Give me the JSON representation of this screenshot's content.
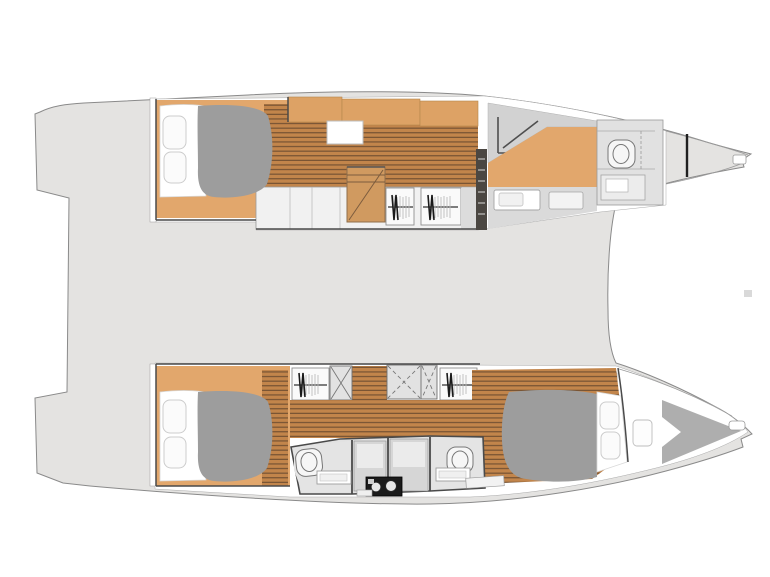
{
  "page": {
    "background": "#ffffff",
    "title": "Catamaran interior floor plan",
    "view": "top-down accommodation layout",
    "vessel_type": "sailing catamaran"
  },
  "colors": {
    "deck": "#e4e3e1",
    "outline": "#8a8a8a",
    "hull_interior": "#ffffff",
    "wall_dark": "#4a4a4a",
    "cabin_floor": "#e2a76c",
    "plank_floor": "#c2854b",
    "plank_line": "#6f4e31",
    "furniture": "#dda265",
    "stairs": "#d09a60",
    "bed_duvet": "#9d9d9d",
    "pillow": "#fbfbfb",
    "pillow_stroke": "#cccccc",
    "wet_floor": "#e2e2e2",
    "wet_panel": "#d6d6d6",
    "fixture": "#f6f6f6",
    "fixture_stroke": "#777777",
    "bow_berth": "#aeaeae",
    "louver": "#4b4742",
    "appliance": "#1b1b1b",
    "artifact": "#d9d9d9"
  },
  "plan": {
    "hulls": [
      {
        "name": "upper hull",
        "bow": "right",
        "rooms": [
          {
            "name": "aft cabin",
            "features": [
              "double berth",
              "two pillows",
              "gray duvet",
              "teak floor"
            ]
          },
          {
            "name": "companionway passage",
            "features": [
              "plank flooring",
              "storage cabinets",
              "overhead hatch"
            ]
          },
          {
            "name": "stairway",
            "features": [
              "steps up to saloon"
            ]
          },
          {
            "name": "hanging wardrobes",
            "count": 2
          },
          {
            "name": "forward bathroom",
            "features": [
              "shower",
              "vanity washbasins",
              "toilet"
            ]
          },
          {
            "name": "bow compartment",
            "features": [
              "collision bulkhead",
              "anchor fitting"
            ]
          }
        ]
      },
      {
        "name": "lower hull",
        "bow": "right",
        "rooms": [
          {
            "name": "aft cabin",
            "features": [
              "double berth",
              "two pillows",
              "gray duvet",
              "teak floor"
            ]
          },
          {
            "name": "companionway passage",
            "features": [
              "plank flooring",
              "hanging wardrobes",
              "cross-braced lockers"
            ]
          },
          {
            "name": "aft bathroom",
            "features": [
              "toilet",
              "vanity washbasin"
            ]
          },
          {
            "name": "forward bathroom",
            "features": [
              "toilet",
              "vanity washbasin"
            ]
          },
          {
            "name": "appliance unit",
            "features": [
              "black appliance with two round elements"
            ]
          },
          {
            "name": "forward cabin",
            "features": [
              "double berth",
              "two pillows",
              "plank flooring",
              "hull hatch"
            ]
          },
          {
            "name": "forepeak",
            "features": [
              "gray crew berth wedge",
              "deck hatch",
              "anchor fitting"
            ]
          }
        ]
      }
    ],
    "deck": {
      "name": "bridge deck",
      "features": [
        "open gray deck area",
        "small deck fitting mark right of center"
      ]
    }
  }
}
